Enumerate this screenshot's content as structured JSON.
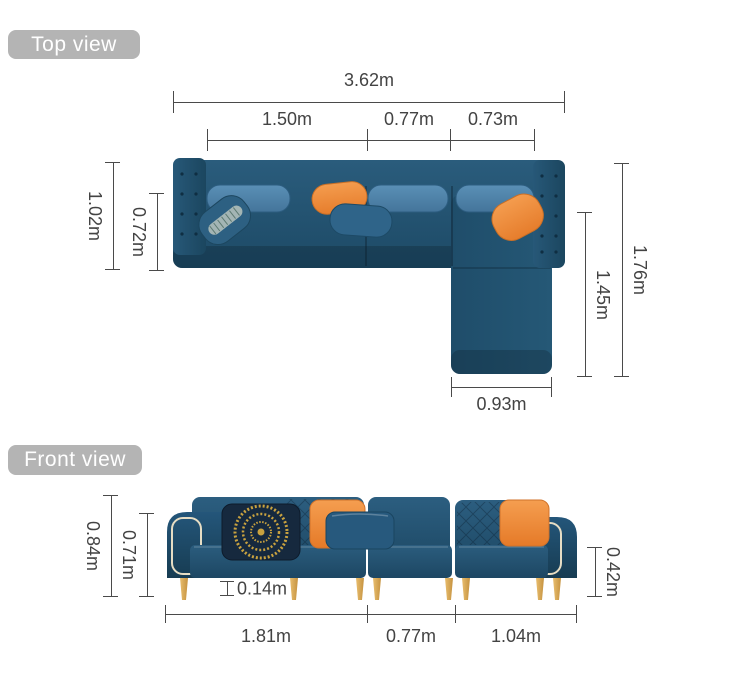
{
  "colors": {
    "badge_bg": "#b4b4b4",
    "badge_text": "#ffffff",
    "dim_line": "#4a4a4a",
    "dim_text": "#434343",
    "sofa_base": "#21506e",
    "sofa_dark": "#16394f",
    "sofa_light": "#2e6589",
    "back_cushion": "#4e84ac",
    "pillow_orange": "#ee8b3c",
    "pillow_navy": "#16293e",
    "medallion_gold": "#c9a23f",
    "leg_gold": "#dcab55",
    "piping": "#e6ddc4"
  },
  "top_view": {
    "badge": "Top view",
    "dims": {
      "total_width": "3.62m",
      "section_left": "1.50m",
      "section_middle": "0.77m",
      "section_right": "0.73m",
      "depth_outer": "1.02m",
      "depth_inner": "0.72m",
      "chaise_outer": "1.76m",
      "chaise_inner": "1.45m",
      "chaise_width": "0.93m"
    }
  },
  "front_view": {
    "badge": "Front view",
    "dims": {
      "height_total": "0.84m",
      "height_back": "0.71m",
      "leg_height": "0.14m",
      "arm_height": "0.42m",
      "width_left": "1.81m",
      "width_middle": "0.77m",
      "width_right": "1.04m"
    }
  }
}
